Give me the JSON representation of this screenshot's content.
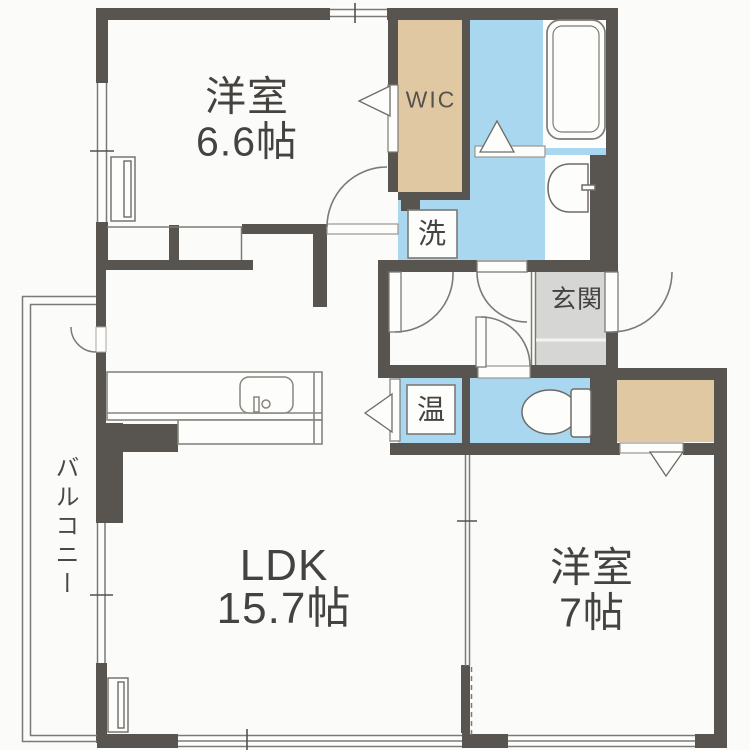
{
  "colors": {
    "wall": "#585550",
    "water_blue": "#a9d7ef",
    "closet_beige": "#e0c9a2",
    "entrance_gray": "#d6d6d4",
    "background": "#fbfbf9",
    "line_gray": "#7a7a76",
    "text": "#454340"
  },
  "rooms": {
    "bedroom1": {
      "name": "洋室",
      "size": "6.6帖"
    },
    "ldk": {
      "name": "LDK",
      "size": "15.7帖"
    },
    "bedroom2": {
      "name": "洋室",
      "size": "7帖"
    },
    "wic": {
      "label": "WIC"
    },
    "entrance": {
      "label": "玄関"
    },
    "laundry": {
      "label": "洗"
    },
    "water_heater": {
      "label": "温"
    },
    "balcony": {
      "label": "バルコニー"
    }
  },
  "icons": {
    "bathtub": "bathtub-icon",
    "toilet": "toilet-icon",
    "wash_basin": "washbasin-icon",
    "kitchen_sink": "kitchen-sink-icon",
    "door_swing": "door-arc-icon",
    "door_direction": "door-triangle-icon"
  }
}
